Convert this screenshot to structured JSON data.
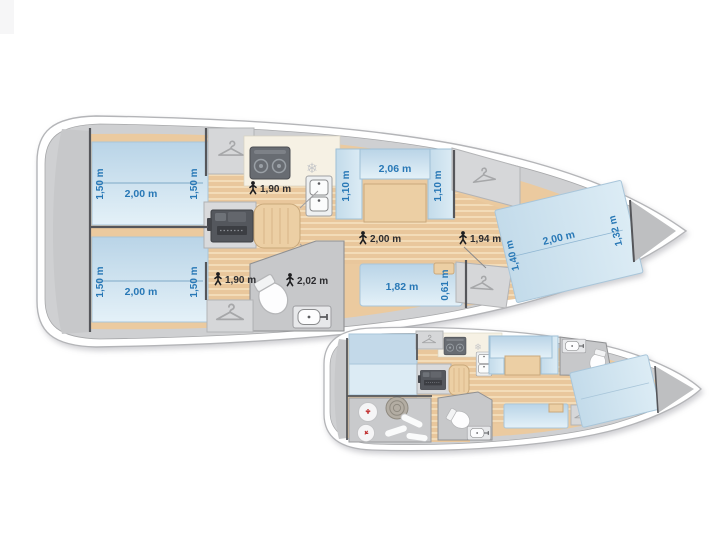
{
  "canvas": {
    "width": 712,
    "height": 534,
    "background": "#ffffff"
  },
  "palette": {
    "hull_white": "#ffffff",
    "hull_line": "#b4b5b8",
    "deck_gray": "#cfd0d2",
    "interior_wood": "#ebca9f",
    "plank_base": "#e9c79c",
    "plank_light": "#f3dcb8",
    "bed_blue": "#bdd6e8",
    "bed_blue_light": "#e3f0f8",
    "counter_cream": "#f6f1e4",
    "locker_gray": "#d6d7d9",
    "head_gray": "#c7c8ca",
    "equipment_dark": "#54575d",
    "wall_dark": "#55565a",
    "dimension_blue": "#2878b6",
    "headroom_dark": "#2c2c2f",
    "accent_red": "#c23535"
  },
  "icons": {
    "freezer_glyph": "❄"
  },
  "upper_plan": {
    "aft_cabin_port": {
      "bed_length": "2,00 m",
      "bed_width_left": "1,50 m",
      "bed_width_right": "1,50 m"
    },
    "aft_cabin_starboard": {
      "bed_length": "2,00 m",
      "bed_width_left": "1,50 m",
      "bed_width_right": "1,50 m"
    },
    "galley": {
      "headroom": "1,90 m"
    },
    "salon": {
      "bench_length": "2,06 m",
      "bench_depth_left": "1,10 m",
      "bench_depth_right": "1,10 m",
      "headroom": "2,00 m"
    },
    "bow": {
      "headroom": "1,94 m"
    },
    "corridor": {
      "headroom": "1,90 m"
    },
    "head": {
      "headroom": "2,02 m"
    },
    "settee": {
      "length": "1,82 m",
      "depth": "0,61 m"
    },
    "bow_cabin": {
      "bed_length": "2,00 m",
      "bed_width_aft": "1,40 m",
      "bed_width_fwd": "1,32 m"
    }
  }
}
